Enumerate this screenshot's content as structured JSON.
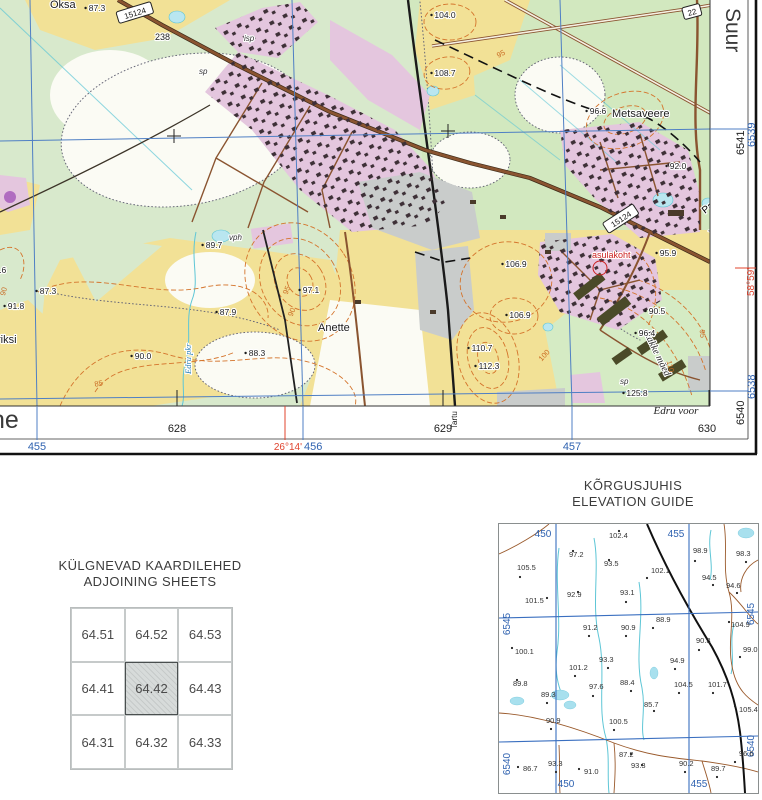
{
  "map": {
    "labels": {
      "oksa": "Oksa",
      "metsaveere": "Metsaveere",
      "paasvere": "Paasvere",
      "vagara": "Vägara",
      "anette": "Anette",
      "riksi": "riksi",
      "asulakoht": "asulakoht",
      "edru_stream": "Edru pkr",
      "rakke_maed": "Rakke mäed",
      "edru_voor": "Edru voor",
      "tartu": "Tartu",
      "margin_name_left": "ne",
      "margin_name_right": "Suur",
      "isp": "isp",
      "sp_a": "sp",
      "vph": "vph",
      "sp_b": "sp",
      "km_post": "238"
    },
    "road_numbers": {
      "r15124a": "15124",
      "r15124b": "15124",
      "r22": "22"
    },
    "grid": {
      "eastings_black": [
        "628",
        "629",
        "630"
      ],
      "eastings_blue": [
        "455",
        "456",
        "457"
      ],
      "northings_black": [
        "6541",
        "6540"
      ],
      "northings_blue": [
        "6539",
        "6538"
      ],
      "longitude": "26°14'",
      "latitude": "58°59'"
    },
    "spot_heights": [
      {
        "x": 97,
        "y": 11,
        "v": "87.3"
      },
      {
        "x": 445,
        "y": 18,
        "v": "104.0"
      },
      {
        "x": 445,
        "y": 76,
        "v": "108.7"
      },
      {
        "x": 598,
        "y": 114,
        "v": "96.6"
      },
      {
        "x": 678,
        "y": 169,
        "v": "92.0"
      },
      {
        "x": 668,
        "y": 256,
        "v": "95.9"
      },
      {
        "x": 657,
        "y": 314,
        "v": "90.5"
      },
      {
        "x": 647,
        "y": 336,
        "v": "96.4"
      },
      {
        "x": 637,
        "y": 396,
        "v": "125.8"
      },
      {
        "x": 516,
        "y": 267,
        "v": "106.9"
      },
      {
        "x": 520,
        "y": 318,
        "v": "106.9"
      },
      {
        "x": 482,
        "y": 351,
        "v": "110.7"
      },
      {
        "x": 489,
        "y": 369,
        "v": "112.3"
      },
      {
        "x": 311,
        "y": 293,
        "v": "97.1"
      },
      {
        "x": 257,
        "y": 356,
        "v": "88.3"
      },
      {
        "x": 228,
        "y": 315,
        "v": "87.9"
      },
      {
        "x": 143,
        "y": 359,
        "v": "90.0"
      },
      {
        "x": 214,
        "y": 248,
        "v": "89.7"
      },
      {
        "x": 48,
        "y": 294,
        "v": "87.3"
      },
      {
        "x": 16,
        "y": 309,
        "v": "91.8"
      },
      {
        "x": -2,
        "y": 273,
        "v": "93.6"
      }
    ],
    "contour_labels": [
      {
        "x": 99,
        "y": 386,
        "rot": -10,
        "v": "85"
      },
      {
        "x": 6,
        "y": 292,
        "rot": -75,
        "v": "90"
      },
      {
        "x": 289,
        "y": 291,
        "rot": -68,
        "v": "95"
      },
      {
        "x": 294,
        "y": 313,
        "rot": -68,
        "v": "90"
      },
      {
        "x": 502,
        "y": 56,
        "rot": -28,
        "v": "95"
      },
      {
        "x": 546,
        "y": 357,
        "rot": -48,
        "v": "100"
      },
      {
        "x": 668,
        "y": 367,
        "rot": 76,
        "v": "110"
      },
      {
        "x": 700,
        "y": 334,
        "rot": 84,
        "v": "95"
      }
    ]
  },
  "adjoining_sheets": {
    "title_et": "KÜLGNEVAD KAARDILEHED",
    "title_en": "ADJOINING SHEETS",
    "cells": [
      "64.51",
      "64.52",
      "64.53",
      "64.41",
      "64.42",
      "64.43",
      "64.31",
      "64.32",
      "64.33"
    ],
    "current": "64.42"
  },
  "elevation_guide": {
    "title_et": "KÕRGUSJUHIS",
    "title_en": "ELEVATION GUIDE",
    "grid_top": [
      "450",
      "455"
    ],
    "grid_bottom": [
      "450",
      "455"
    ],
    "grid_left": [
      "6545",
      "6540"
    ],
    "grid_right": [
      "6545",
      "6540"
    ],
    "points": [
      {
        "x": 110,
        "y": 14,
        "d": [
          120,
          7
        ],
        "v": "102.4"
      },
      {
        "x": 70,
        "y": 33,
        "d": [
          74,
          27
        ],
        "v": "97.2"
      },
      {
        "x": 105,
        "y": 42,
        "d": [
          110,
          36
        ],
        "v": "93.5"
      },
      {
        "x": 152,
        "y": 49,
        "d": [
          148,
          54
        ],
        "v": "102.1"
      },
      {
        "x": 194,
        "y": 29,
        "d": [
          196,
          37
        ],
        "v": "98.9"
      },
      {
        "x": 237,
        "y": 32,
        "d": [
          247,
          38
        ],
        "v": "98.3"
      },
      {
        "x": 18,
        "y": 46,
        "d": [
          21,
          53
        ],
        "v": "105.5"
      },
      {
        "x": 203,
        "y": 56,
        "d": [
          214,
          61
        ],
        "v": "94.5"
      },
      {
        "x": 227,
        "y": 64,
        "d": [
          238,
          69
        ],
        "v": "94.6"
      },
      {
        "x": 68,
        "y": 73,
        "d": [
          79,
          68
        ],
        "v": "92.9"
      },
      {
        "x": 121,
        "y": 71,
        "d": [
          127,
          78
        ],
        "v": "93.1"
      },
      {
        "x": 26,
        "y": 79,
        "d": [
          48,
          74
        ],
        "v": "101.5"
      },
      {
        "x": 84,
        "y": 106,
        "d": [
          90,
          112
        ],
        "v": "91.2"
      },
      {
        "x": 122,
        "y": 106,
        "d": [
          127,
          112
        ],
        "v": "90.9"
      },
      {
        "x": 157,
        "y": 98,
        "d": [
          154,
          104
        ],
        "v": "88.9"
      },
      {
        "x": 232,
        "y": 103,
        "d": [
          230,
          98
        ],
        "v": "104.9"
      },
      {
        "x": 197,
        "y": 119,
        "d": [
          200,
          126
        ],
        "v": "90.3"
      },
      {
        "x": 244,
        "y": 128,
        "d": [
          241,
          133
        ],
        "v": "99.0"
      },
      {
        "x": 16,
        "y": 130,
        "d": [
          13,
          124
        ],
        "v": "100.1"
      },
      {
        "x": 100,
        "y": 138,
        "d": [
          109,
          144
        ],
        "v": "93.3"
      },
      {
        "x": 70,
        "y": 146,
        "d": [
          76,
          152
        ],
        "v": "101.2"
      },
      {
        "x": 14,
        "y": 162,
        "d": [
          18,
          156
        ],
        "v": "89.8"
      },
      {
        "x": 90,
        "y": 165,
        "d": [
          94,
          172
        ],
        "v": "97.6"
      },
      {
        "x": 121,
        "y": 161,
        "d": [
          132,
          167
        ],
        "v": "88.4"
      },
      {
        "x": 171,
        "y": 139,
        "d": [
          176,
          145
        ],
        "v": "94.9"
      },
      {
        "x": 175,
        "y": 163,
        "d": [
          180,
          169
        ],
        "v": "104.5"
      },
      {
        "x": 209,
        "y": 163,
        "d": [
          214,
          169
        ],
        "v": "101.7"
      },
      {
        "x": 42,
        "y": 173,
        "d": [
          48,
          179
        ],
        "v": "89.3"
      },
      {
        "x": 145,
        "y": 183,
        "d": [
          155,
          187
        ],
        "v": "85.7"
      },
      {
        "x": 240,
        "y": 188,
        "d": [
          236,
          182
        ],
        "v": "105.4"
      },
      {
        "x": 47,
        "y": 199,
        "d": [
          52,
          205
        ],
        "v": "90.9"
      },
      {
        "x": 110,
        "y": 200,
        "d": [
          115,
          206
        ],
        "v": "100.5"
      },
      {
        "x": 120,
        "y": 233,
        "d": [
          132,
          230
        ],
        "v": "87.2"
      },
      {
        "x": 49,
        "y": 242,
        "d": [
          57,
          248
        ],
        "v": "93.3"
      },
      {
        "x": 24,
        "y": 247,
        "d": [
          19,
          243
        ],
        "v": "86.7"
      },
      {
        "x": 85,
        "y": 250,
        "d": [
          80,
          245
        ],
        "v": "91.0"
      },
      {
        "x": 132,
        "y": 244,
        "d": [
          143,
          241
        ],
        "v": "93.3"
      },
      {
        "x": 180,
        "y": 242,
        "d": [
          186,
          248
        ],
        "v": "90.2"
      },
      {
        "x": 212,
        "y": 247,
        "d": [
          218,
          253
        ],
        "v": "89.7"
      },
      {
        "x": 240,
        "y": 232,
        "d": [
          236,
          238
        ],
        "v": "96.6"
      }
    ]
  },
  "colors": {
    "field_yellow": "#f2e196",
    "pasture_green": "#d8e9cc",
    "forest_green": "#d2e8bf",
    "builtup_pink": "#e4c6de",
    "hill_orange": "#f4cd87",
    "road_brown": "#8a5430",
    "water_fill": "#b9e6f0",
    "stream": "#5ec6d6",
    "contour_orange": "#d4742c",
    "grid_blue": "#4f7fc4",
    "label_blue": "#2f62b0",
    "geo_red": "#e0442e",
    "gray_area": "#c9cccb"
  }
}
